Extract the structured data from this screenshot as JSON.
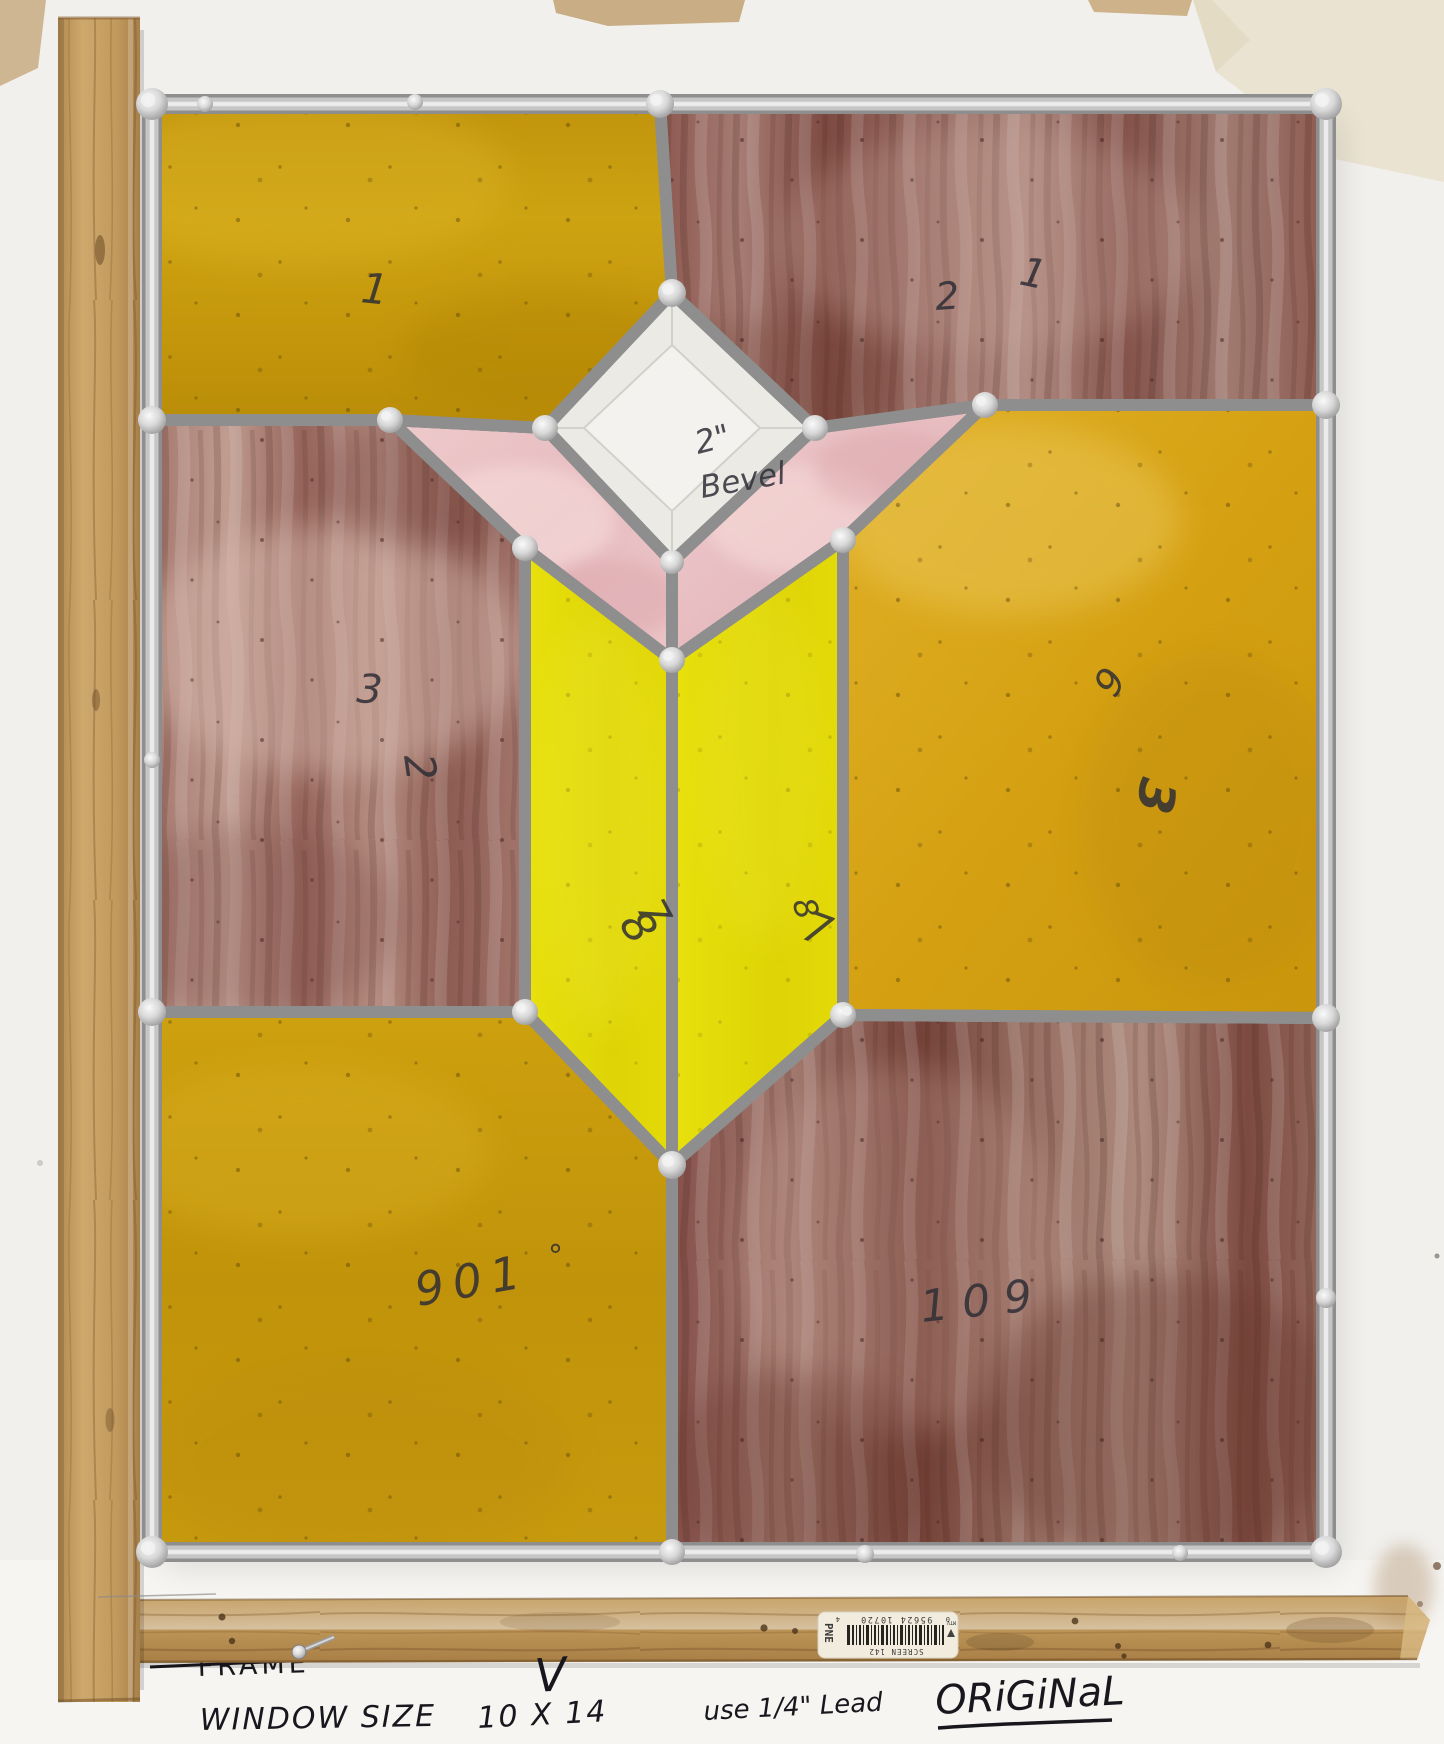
{
  "labels": {
    "tl": "1",
    "tr_2": "2",
    "tr_1": "1",
    "bevel_size": "2\"",
    "bevel_word": "Bevel",
    "ml_3": "3",
    "ml_2": "2",
    "mr_6": "6",
    "mr_3": "3",
    "stem_l_8": "8",
    "stem_l_7": "7",
    "stem_r_8": "8",
    "stem_r_7": "7",
    "bl": "901",
    "bl_deg": "°",
    "br": "109"
  },
  "sticker": {
    "brand_side": "PNE",
    "title": "SCREEN 142",
    "digit_left": "0",
    "digits": "95624 10720",
    "digit_right": "4",
    "logo_text": "MTV"
  },
  "notes": {
    "fragment": "3",
    "crossed_out": "FRAME",
    "checkmark": "V",
    "window_size_label": "WINDOW SIZE",
    "window_size_value": "10 X 14",
    "lead_note": "use 1/4\" Lead",
    "original": "ORiGiNaL"
  },
  "colors": {
    "amber_glass": "#c99e10",
    "bright_yellow_glass": "#e6de0b",
    "maroon_glass": "#8d5a51",
    "pink_glass": "#eac3c6",
    "bevel_clear": "#edece8",
    "came_silver": "#c6c6c6",
    "wood": "#c6a165",
    "background": "#f2f1ee"
  }
}
